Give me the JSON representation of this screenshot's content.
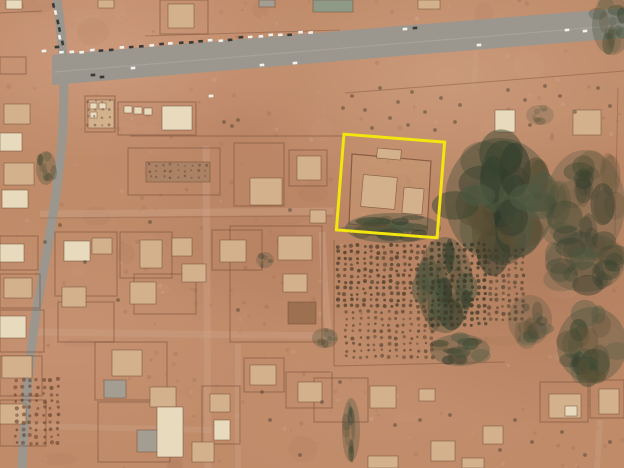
{
  "image": {
    "kind": "satellite-aerial-photo",
    "description": "Overhead satellite view of a desert town: paved highway across the top with a line of parked vehicles, diagonal road on the left, walled residential compounds, an orchard of planted tree rows at right, and a yellow annotation box highlighting one compound",
    "annotation_color": "#f3e50e"
  },
  "scene": {
    "width": 624,
    "height": 468,
    "palette": {
      "road": "#9b968e",
      "road_median": "#aba69c",
      "dirt_road": "#cba084",
      "wall": "#7c523a",
      "tan": "#d2b18c",
      "cream": "#e8dabd",
      "gray": "#a49e92",
      "greengray": "#8f9a86",
      "brown": "#9c7050",
      "brown_light": "#ab8263",
      "veg_base": "#46513d",
      "tree_dot": "#4a3e2a",
      "scrub": "#4c4230",
      "car_white": "#f2f2ee",
      "car_dark": "#3a3a38",
      "speckle_dark": "#6d4a34",
      "speckle_light": "#e9cdb4",
      "highlight": "#f3e50e"
    },
    "speckles": {
      "seed": 11,
      "count": 320,
      "smudges": 42
    },
    "dirt_roads": [
      {
        "d": "M 40,214 L 334,211",
        "w": 7,
        "o": 0.5
      },
      {
        "d": "M 206,146 L 208,468",
        "w": 7,
        "o": 0.45
      },
      {
        "d": "M 322,232 C 324,270 325,310 330,342",
        "w": 7,
        "o": 0.5
      },
      {
        "d": "M 36,332 L 334,336",
        "w": 7,
        "o": 0.45
      },
      {
        "d": "M 30,426 L 212,430",
        "w": 6,
        "o": 0.4
      },
      {
        "d": "M 238,344 L 238,468",
        "w": 6,
        "o": 0.4
      },
      {
        "d": "M 478,22 L 474,88",
        "w": 5,
        "o": 0.35
      },
      {
        "d": "M 600,420 L 597,468",
        "w": 6,
        "o": 0.4
      }
    ],
    "roads": {
      "surface": "M 52,55 C 230,40 420,24 624,8 L 624,38 C 420,54 230,70 52,85 Z",
      "median": "M 54,72 C 240,57 430,41 624,25",
      "diagonal": "M 57,0 C 63,40 66,90 62,140 C 58,190 50,235 40,290 C 31,340 25,400 22,468",
      "diagonal_width": 9
    },
    "walls": {
      "rects": [
        [
          160,
          0,
          48,
          34
        ],
        [
          85,
          96,
          30,
          36
        ],
        [
          118,
          102,
          78,
          33
        ],
        [
          128,
          148,
          92,
          47
        ],
        [
          234,
          143,
          50,
          63
        ],
        [
          289,
          150,
          38,
          36
        ],
        [
          0,
          57,
          26,
          17
        ],
        [
          55,
          232,
          62,
          64
        ],
        [
          120,
          232,
          52,
          46
        ],
        [
          134,
          274,
          62,
          40
        ],
        [
          212,
          230,
          50,
          40
        ],
        [
          230,
          226,
          92,
          116
        ],
        [
          95,
          342,
          72,
          58
        ],
        [
          98,
          402,
          72,
          60
        ],
        [
          202,
          386,
          38,
          58
        ],
        [
          244,
          358,
          40,
          34
        ],
        [
          286,
          372,
          46,
          36
        ],
        [
          540,
          382,
          48,
          40
        ],
        [
          590,
          380,
          34,
          38
        ],
        [
          314,
          378,
          54,
          44
        ],
        [
          58,
          302,
          56,
          40
        ],
        [
          0,
          236,
          38,
          34
        ],
        [
          0,
          274,
          40,
          34
        ],
        [
          0,
          310,
          44,
          42
        ],
        [
          0,
          356,
          42,
          40
        ],
        [
          0,
          400,
          46,
          46
        ]
      ],
      "lines": [
        {
          "d": "M 130,136 L 345,136",
          "o": 0.6
        },
        {
          "d": "M 145,36 L 340,30",
          "o": 0.45
        },
        {
          "d": "M 345,93 C 430,87 520,79 624,71",
          "o": 0.45
        },
        {
          "d": "M 334,240 L 334,366",
          "o": 0.55
        },
        {
          "d": "M 334,366 L 505,362",
          "o": 0.5
        },
        {
          "d": "M 0,13 L 42,11",
          "o": 0.55
        },
        {
          "d": "M 618,88 L 615,235",
          "o": 0.4
        },
        {
          "d": "M 40,218 L 332,216",
          "o": 0.3
        },
        {
          "d": "M 426,244 L 430,330",
          "o": 0.4
        }
      ],
      "polygons": [
        {
          "pts": "352,154 431,161 427,231 349,224",
          "fill": "#c99b77",
          "fo": 0.6,
          "o": 0.8
        }
      ]
    },
    "buildings": [
      [
        6,
        0,
        16,
        9,
        "cream"
      ],
      [
        98,
        0,
        16,
        8,
        "tan"
      ],
      [
        168,
        4,
        26,
        24,
        "tan"
      ],
      [
        313,
        0,
        40,
        12,
        "greengray"
      ],
      [
        259,
        0,
        16,
        7,
        "gray"
      ],
      [
        418,
        0,
        22,
        9,
        "tan"
      ],
      [
        4,
        104,
        26,
        20,
        "tan"
      ],
      [
        0,
        133,
        22,
        18,
        "cream"
      ],
      [
        4,
        163,
        30,
        22,
        "tan"
      ],
      [
        2,
        190,
        26,
        18,
        "cream"
      ],
      [
        0,
        244,
        24,
        18,
        "cream"
      ],
      [
        4,
        278,
        28,
        20,
        "tan"
      ],
      [
        0,
        316,
        26,
        22,
        "cream"
      ],
      [
        2,
        356,
        30,
        22,
        "tan"
      ],
      [
        0,
        404,
        26,
        20,
        "tan"
      ],
      [
        88,
        100,
        26,
        28,
        "tan"
      ],
      [
        90,
        103,
        7,
        6,
        "cream"
      ],
      [
        99,
        103,
        7,
        6,
        "cream"
      ],
      [
        90,
        112,
        7,
        6,
        "cream"
      ],
      [
        162,
        106,
        30,
        24,
        "cream"
      ],
      [
        124,
        106,
        8,
        7,
        "cream"
      ],
      [
        134,
        107,
        8,
        7,
        "cream"
      ],
      [
        144,
        108,
        8,
        7,
        "cream"
      ],
      [
        146,
        162,
        64,
        20,
        "brown_light"
      ],
      [
        250,
        178,
        32,
        27,
        "tan"
      ],
      [
        297,
        156,
        24,
        24,
        "tan"
      ],
      [
        310,
        210,
        16,
        13,
        "tan"
      ],
      [
        362,
        176,
        34,
        32,
        "tan",
        5
      ],
      [
        403,
        188,
        20,
        26,
        "tan",
        5
      ],
      [
        377,
        149,
        24,
        10,
        "tan",
        5
      ],
      [
        495,
        110,
        20,
        22,
        "cream"
      ],
      [
        573,
        110,
        28,
        25,
        "tan"
      ],
      [
        64,
        241,
        26,
        20,
        "cream"
      ],
      [
        92,
        238,
        20,
        16,
        "tan"
      ],
      [
        140,
        240,
        22,
        28,
        "tan"
      ],
      [
        172,
        238,
        20,
        18,
        "tan"
      ],
      [
        220,
        240,
        26,
        22,
        "tan"
      ],
      [
        182,
        264,
        24,
        18,
        "tan"
      ],
      [
        130,
        282,
        26,
        22,
        "tan"
      ],
      [
        62,
        287,
        24,
        20,
        "tan"
      ],
      [
        112,
        350,
        30,
        26,
        "tan"
      ],
      [
        104,
        380,
        22,
        18,
        "gray"
      ],
      [
        150,
        387,
        26,
        20,
        "tan"
      ],
      [
        137,
        430,
        24,
        22,
        "gray"
      ],
      [
        157,
        407,
        26,
        50,
        "cream"
      ],
      [
        192,
        442,
        22,
        20,
        "tan"
      ],
      [
        278,
        236,
        34,
        24,
        "tan"
      ],
      [
        283,
        274,
        24,
        18,
        "tan"
      ],
      [
        288,
        302,
        28,
        22,
        "brown"
      ],
      [
        250,
        365,
        26,
        20,
        "tan"
      ],
      [
        298,
        382,
        24,
        20,
        "tan"
      ],
      [
        210,
        394,
        20,
        18,
        "tan"
      ],
      [
        214,
        420,
        16,
        20,
        "cream"
      ],
      [
        370,
        386,
        26,
        22,
        "tan"
      ],
      [
        419,
        389,
        16,
        12,
        "tan"
      ],
      [
        483,
        426,
        20,
        18,
        "tan"
      ],
      [
        431,
        441,
        24,
        20,
        "tan"
      ],
      [
        549,
        394,
        32,
        24,
        "tan"
      ],
      [
        565,
        406,
        12,
        10,
        "cream"
      ],
      [
        599,
        389,
        20,
        25,
        "tan"
      ],
      [
        368,
        456,
        30,
        12,
        "tan"
      ],
      [
        462,
        458,
        22,
        10,
        "tan"
      ]
    ],
    "vegetation": [
      [
        500,
        200,
        55,
        62,
        40,
        3,
        0.85
      ],
      [
        585,
        205,
        40,
        55,
        25,
        4,
        0.55
      ],
      [
        445,
        285,
        28,
        48,
        22,
        5,
        0.8
      ],
      [
        585,
        262,
        40,
        30,
        20,
        6,
        0.6
      ],
      [
        592,
        345,
        35,
        38,
        22,
        7,
        0.7
      ],
      [
        393,
        228,
        48,
        15,
        18,
        8,
        0.85
      ],
      [
        612,
        25,
        20,
        30,
        12,
        9,
        0.6
      ],
      [
        46,
        168,
        10,
        17,
        8,
        10,
        0.6
      ],
      [
        351,
        430,
        9,
        32,
        10,
        12,
        0.6
      ],
      [
        265,
        260,
        9,
        8,
        5,
        13,
        0.5
      ],
      [
        325,
        338,
        13,
        10,
        6,
        14,
        0.6
      ],
      [
        540,
        115,
        14,
        10,
        6,
        15,
        0.4
      ],
      [
        460,
        350,
        30,
        16,
        14,
        16,
        0.7
      ],
      [
        530,
        320,
        22,
        25,
        15,
        17,
        0.5
      ]
    ],
    "trees": [
      [
        352,
        96
      ],
      [
        365,
        110
      ],
      [
        380,
        88
      ],
      [
        398,
        102
      ],
      [
        412,
        92
      ],
      [
        425,
        112
      ],
      [
        441,
        98
      ],
      [
        455,
        122
      ],
      [
        408,
        125
      ],
      [
        372,
        128
      ],
      [
        390,
        118
      ],
      [
        435,
        130
      ],
      [
        460,
        105
      ],
      [
        343,
        108
      ],
      [
        508,
        90
      ],
      [
        525,
        100
      ],
      [
        545,
        86
      ],
      [
        560,
        96
      ],
      [
        598,
        88
      ],
      [
        610,
        106
      ],
      [
        575,
        112
      ],
      [
        530,
        125
      ],
      [
        270,
        420
      ],
      [
        300,
        455
      ],
      [
        420,
        420
      ],
      [
        500,
        450
      ],
      [
        532,
        442
      ],
      [
        562,
        432
      ],
      [
        610,
        442
      ],
      [
        322,
        402
      ],
      [
        340,
        382
      ],
      [
        262,
        392
      ],
      [
        238,
        310
      ],
      [
        60,
        225
      ],
      [
        150,
        222
      ],
      [
        118,
        300
      ],
      [
        85,
        262
      ],
      [
        45,
        242
      ],
      [
        290,
        210
      ],
      [
        395,
        425
      ],
      [
        450,
        415
      ],
      [
        515,
        420
      ],
      [
        585,
        455
      ],
      [
        224,
        122
      ],
      [
        232,
        126
      ],
      [
        238,
        120
      ]
    ],
    "tree_grids": [
      [
        338,
        246,
        14,
        11,
        6.6,
        6.0,
        1.7,
        0.8,
        "#4f3f2c"
      ],
      [
        346,
        312,
        13,
        8,
        7.2,
        6.4,
        1.6,
        0.65,
        "#4f3f2c"
      ],
      [
        432,
        244,
        9,
        14,
        6.6,
        6.2,
        1.8,
        0.85,
        "#3e3a28"
      ],
      [
        490,
        250,
        6,
        12,
        6.5,
        6.3,
        1.7,
        0.6,
        "#3e3a28"
      ],
      [
        16,
        380,
        7,
        10,
        7.0,
        7.0,
        1.7,
        0.7,
        "#6b4632"
      ],
      [
        150,
        165,
        9,
        3,
        7.0,
        6.0,
        1.2,
        0.5,
        "#5f4130"
      ],
      [
        88,
        101,
        4,
        4,
        7.0,
        8.0,
        1.2,
        0.5,
        "#5f4130"
      ]
    ],
    "cars": {
      "parked_rows": [
        {
          "x0": 62,
          "y0": 53,
          "x1": 310,
          "y1": 32,
          "count": 26,
          "seed": 21
        },
        {
          "x0": 54,
          "y0": 6,
          "x1": 62,
          "y1": 44,
          "count": 6,
          "seed": 22
        }
      ],
      "singles": [
        [
          133,
          68,
          "w"
        ],
        [
          262,
          65,
          "w"
        ],
        [
          295,
          63,
          "w"
        ],
        [
          479,
          45,
          "w"
        ],
        [
          567,
          30,
          "w"
        ],
        [
          585,
          31,
          "w"
        ],
        [
          211,
          96,
          "w"
        ],
        [
          44,
          51,
          "w"
        ],
        [
          405,
          29,
          "w"
        ],
        [
          93,
          75,
          "d"
        ],
        [
          102,
          77,
          "d"
        ],
        [
          415,
          28,
          "d"
        ],
        [
          57,
          47,
          "d"
        ]
      ]
    },
    "highlight_box": {
      "x": 340,
      "y": 138,
      "w": 101,
      "h": 96,
      "rot": 4.5,
      "cx": 390.5,
      "cy": 186,
      "stroke_width": 3
    }
  }
}
